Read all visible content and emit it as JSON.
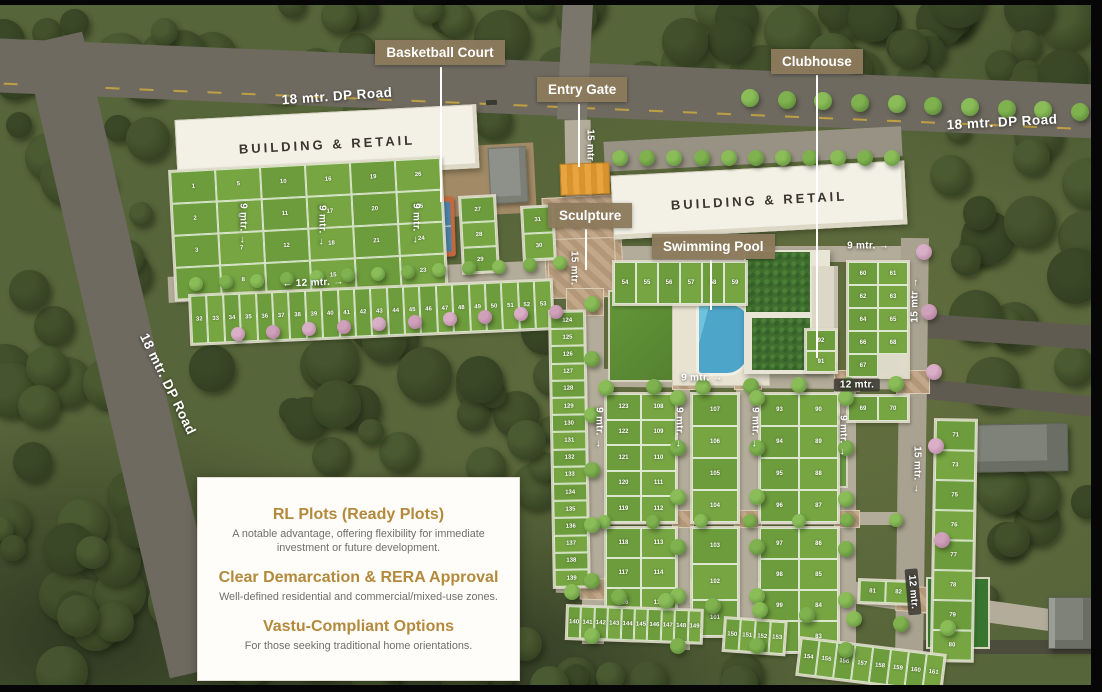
{
  "callouts": [
    {
      "id": "basketball-court",
      "label": "Basketball Court",
      "box": {
        "x": 375,
        "y": 40,
        "w": 130,
        "h": 27
      },
      "line": {
        "x": 440,
        "y1": 67,
        "y2": 202
      }
    },
    {
      "id": "entry-gate",
      "label": "Entry Gate",
      "box": {
        "x": 537,
        "y": 77,
        "w": 84,
        "h": 27
      },
      "line": {
        "x": 578,
        "y1": 104,
        "y2": 167
      }
    },
    {
      "id": "sculpture",
      "label": "Sculpture",
      "box": {
        "x": 548,
        "y": 203,
        "w": 82,
        "h": 26
      },
      "line": {
        "x": 585,
        "y1": 229,
        "y2": 270
      }
    },
    {
      "id": "swimming-pool",
      "label": "Swimming Pool",
      "box": {
        "x": 652,
        "y": 234,
        "w": 112,
        "h": 26
      },
      "line": {
        "x": 710,
        "y1": 260,
        "y2": 310
      }
    },
    {
      "id": "clubhouse",
      "label": "Clubhouse",
      "box": {
        "x": 771,
        "y": 49,
        "w": 88,
        "h": 26
      },
      "line": {
        "x": 816,
        "y1": 75,
        "y2": 358
      }
    }
  ],
  "dp_road_labels": [
    {
      "text": "18 mtr. DP Road",
      "cx": 337,
      "cy": 96,
      "rot": -4
    },
    {
      "text": "18 mtr. DP Road",
      "cx": 1002,
      "cy": 122,
      "rot": -3
    },
    {
      "text": "18 mtr. DP Road",
      "cx": 168,
      "cy": 384,
      "rot": 64
    }
  ],
  "buildings": [
    {
      "label": "BUILDING & RETAIL"
    },
    {
      "label": "BUILDING & RETAIL"
    }
  ],
  "measure_labels": [
    {
      "text": "12 mtr.",
      "cx": 313,
      "cy": 283,
      "rot": -2,
      "arrows": "both"
    },
    {
      "text": "9 mtr.",
      "cx": 243,
      "cy": 224,
      "rot": 90,
      "arrows": "end"
    },
    {
      "text": "9 mtr.",
      "cx": 322,
      "cy": 226,
      "rot": 90,
      "arrows": "end"
    },
    {
      "text": "9 mtr.",
      "cx": 416,
      "cy": 224,
      "rot": 90,
      "arrows": "end"
    },
    {
      "text": "15 mtr",
      "cx": 590,
      "cy": 145,
      "rot": 90,
      "arrows": "none"
    },
    {
      "text": "15 mtr.",
      "cx": 574,
      "cy": 268,
      "rot": 90,
      "arrows": "none"
    },
    {
      "text": "9 mtr.",
      "cx": 868,
      "cy": 246,
      "rot": 0,
      "arrows": "end"
    },
    {
      "text": "9 mtr.",
      "cx": 702,
      "cy": 378,
      "rot": 0,
      "arrows": "end"
    },
    {
      "text": "12 mtr.",
      "cx": 857,
      "cy": 385,
      "rot": 0,
      "arrows": "none",
      "badge": true
    },
    {
      "text": "15 mtr",
      "cx": 915,
      "cy": 300,
      "rot": -90,
      "arrows": "end"
    },
    {
      "text": "15 mtr.",
      "cx": 917,
      "cy": 470,
      "rot": 90,
      "arrows": "end"
    },
    {
      "text": "12 mtr.",
      "cx": 913,
      "cy": 592,
      "rot": 85,
      "arrows": "none",
      "badge": true
    },
    {
      "text": "9 mtr.",
      "cx": 599,
      "cy": 428,
      "rot": 90,
      "arrows": "end"
    },
    {
      "text": "9 mtr.",
      "cx": 679,
      "cy": 428,
      "rot": 90,
      "arrows": "end"
    },
    {
      "text": "9 mtr.",
      "cx": 755,
      "cy": 428,
      "rot": 90,
      "arrows": "end"
    },
    {
      "text": "9 mtr.",
      "cx": 843,
      "cy": 436,
      "rot": 90,
      "arrows": "end"
    }
  ],
  "info_card": {
    "items": [
      {
        "title": "RL Plots (Ready Plots)",
        "body": "A notable advantage, offering flexibility for immediate investment or future development."
      },
      {
        "title": "Clear Demarcation & RERA Approval",
        "body": "Well-defined residential and commercial/mixed-use zones."
      },
      {
        "title": "Vastu-Compliant Options",
        "body": "For those seeking traditional home orientations."
      }
    ]
  },
  "plot_clusters": [
    {
      "name": "northwest-cluster",
      "x": 168,
      "y": 170,
      "rot": -3,
      "cw": 45,
      "ch": 32,
      "cols": 6,
      "nums": [
        1,
        5,
        10,
        16,
        19,
        26,
        2,
        6,
        11,
        17,
        20,
        25,
        3,
        7,
        12,
        18,
        21,
        24,
        4,
        8,
        13,
        15,
        22,
        23
      ]
    },
    {
      "name": "west-strip-a",
      "x": 458,
      "y": 196,
      "rot": -3,
      "cw": 34,
      "ch": 25,
      "cols": 1,
      "nums": [
        27,
        28,
        29
      ]
    },
    {
      "name": "west-strip-b",
      "x": 520,
      "y": 206,
      "rot": -3,
      "cw": 30,
      "ch": 26,
      "cols": 1,
      "nums": [
        31,
        30
      ]
    },
    {
      "name": "boulevard-row",
      "x": 188,
      "y": 294,
      "rot": -2.5,
      "cw": 16.4,
      "ch": 48,
      "cols": 22,
      "nums": [
        32,
        33,
        34,
        35,
        36,
        37,
        38,
        39,
        40,
        41,
        42,
        43,
        44,
        45,
        46,
        47,
        48,
        49,
        50,
        51,
        52,
        53
      ]
    },
    {
      "name": "west-column",
      "x": 548,
      "y": 310,
      "rot": -1,
      "cw": 34,
      "ch": 17.2,
      "cols": 1,
      "nums": [
        124,
        125,
        126,
        127,
        128,
        129,
        130,
        131,
        132,
        133,
        134,
        135,
        136,
        137,
        138,
        139
      ]
    },
    {
      "name": "pool-row",
      "x": 612,
      "y": 260,
      "rot": 0,
      "cw": 22,
      "ch": 42,
      "cols": 6,
      "nums": [
        54,
        55,
        56,
        57,
        58,
        59
      ]
    },
    {
      "name": "clubhouse-east-pair",
      "x": 804,
      "y": 328,
      "rot": 0,
      "cw": 30,
      "ch": 21,
      "cols": 1,
      "nums": [
        92,
        91
      ]
    },
    {
      "name": "east-cluster",
      "x": 846,
      "y": 260,
      "rot": 0,
      "cw": 30,
      "ch": 23,
      "cols": 2,
      "nums": [
        60,
        61,
        62,
        63,
        64,
        65,
        66,
        68,
        67,
        null
      ]
    },
    {
      "name": "east-pair",
      "x": 846,
      "y": 394,
      "rot": 0,
      "cw": 30,
      "ch": 25,
      "cols": 2,
      "nums": [
        69,
        70
      ]
    },
    {
      "name": "central-nw",
      "x": 604,
      "y": 392,
      "rot": 0,
      "cw": 35,
      "ch": 25.5,
      "cols": 2,
      "nums": [
        123,
        108,
        122,
        109,
        121,
        110,
        120,
        111,
        119,
        112
      ]
    },
    {
      "name": "central-sw",
      "x": 604,
      "y": 526,
      "rot": 0,
      "cw": 35,
      "ch": 30,
      "cols": 2,
      "nums": [
        118,
        113,
        117,
        114,
        116,
        115
      ]
    },
    {
      "name": "central-n",
      "x": 690,
      "y": 392,
      "rot": 0,
      "cw": 46,
      "ch": 32,
      "cols": 1,
      "nums": [
        107,
        106,
        105,
        104
      ]
    },
    {
      "name": "central-s",
      "x": 690,
      "y": 526,
      "rot": 0,
      "cw": 46,
      "ch": 36,
      "cols": 1,
      "nums": [
        103,
        102,
        101
      ]
    },
    {
      "name": "central-ne",
      "x": 758,
      "y": 392,
      "rot": 0,
      "cw": 39,
      "ch": 32,
      "cols": 2,
      "nums": [
        93,
        90,
        94,
        89,
        95,
        88,
        96,
        87
      ]
    },
    {
      "name": "central-se",
      "x": 758,
      "y": 526,
      "rot": 0,
      "cw": 39,
      "ch": 31,
      "cols": 2,
      "nums": [
        97,
        86,
        98,
        85,
        99,
        84,
        100,
        83
      ]
    },
    {
      "name": "east-column",
      "x": 934,
      "y": 418,
      "rot": 1,
      "cw": 40,
      "ch": 30,
      "cols": 1,
      "nums": [
        71,
        73,
        75,
        76,
        77,
        78,
        79,
        80
      ]
    },
    {
      "name": "southeast-pair",
      "x": 858,
      "y": 578,
      "rot": 2,
      "cw": 26,
      "ch": 22,
      "cols": 2,
      "nums": [
        81,
        82
      ]
    },
    {
      "name": "south-row-a",
      "x": 566,
      "y": 604,
      "rot": 2,
      "cw": 13.4,
      "ch": 32,
      "cols": 10,
      "nums": [
        140,
        141,
        142,
        143,
        144,
        145,
        146,
        147,
        148,
        149
      ]
    },
    {
      "name": "south-row-b",
      "x": 724,
      "y": 616,
      "rot": 4,
      "cw": 15,
      "ch": 32,
      "cols": 4,
      "nums": [
        150,
        151,
        152,
        153
      ]
    },
    {
      "name": "south-row-c",
      "x": 800,
      "y": 636,
      "rot": 7,
      "cw": 18,
      "ch": 36,
      "cols": 8,
      "nums": [
        154,
        155,
        156,
        157,
        158,
        159,
        160,
        161
      ]
    }
  ],
  "colors": {
    "label_bg": "#8d7a5c",
    "gold": "#b3893c",
    "plot_green": "#74a340",
    "road_gray": "#6e6a60",
    "internal_road": "#b4ac9a",
    "pool_blue": "#59b1d2",
    "court_blue": "#4c80a8",
    "court_rim": "#c4683d",
    "gate_orange": "#e8a53e"
  }
}
